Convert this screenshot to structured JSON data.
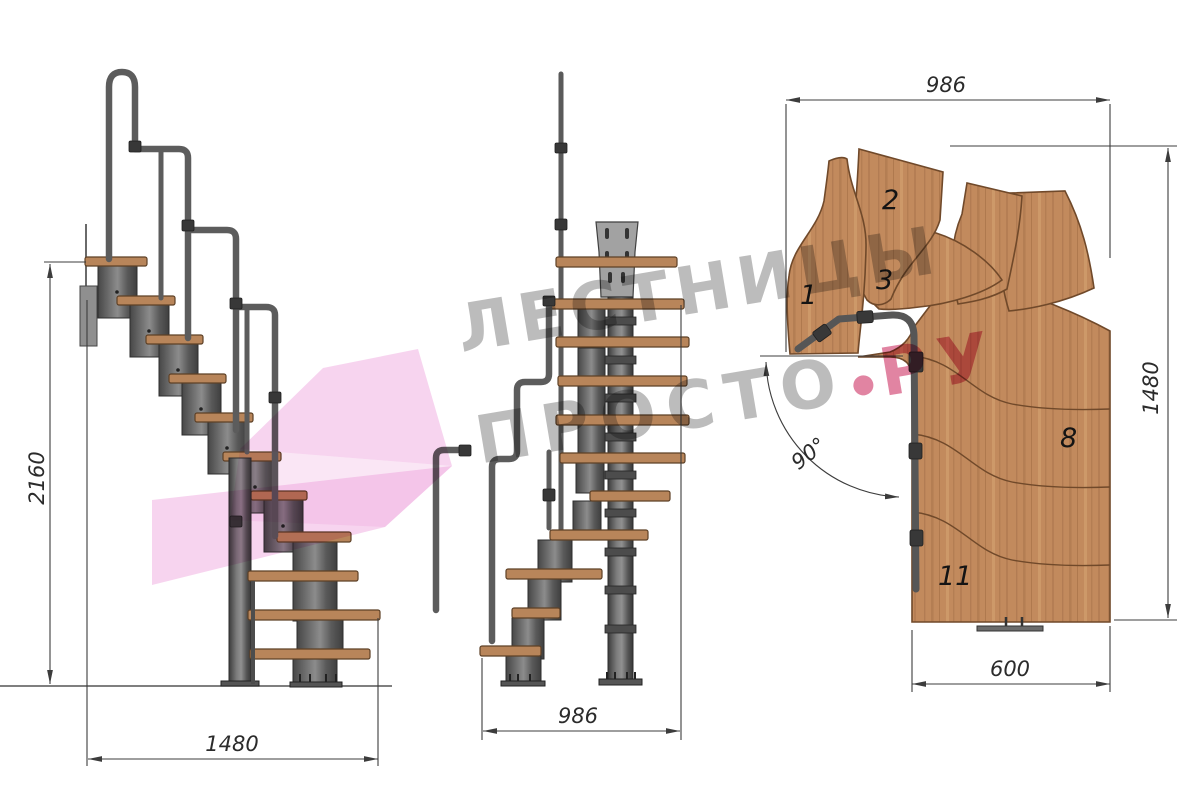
{
  "watermark": {
    "line1": "ЛЕСТНИЦЫ",
    "line2_left": "ПРОСТО",
    "line2_right": "РУ"
  },
  "side_view": {
    "dim_height": "2160",
    "dim_depth": "1480"
  },
  "front_view": {
    "dim_width": "986"
  },
  "plan_view": {
    "dim_width_top": "986",
    "dim_height": "1480",
    "dim_bottom_width": "600",
    "turn_angle": "90°",
    "tread_numbers": {
      "n1": "1",
      "n2": "2",
      "n3": "3",
      "n8": "8",
      "n11": "11"
    }
  },
  "colors": {
    "wood": "#c28a5d",
    "wood_outline": "#70492a",
    "metal_module": "#5a5a5a",
    "handrail_tube": "#5c5c5c",
    "dimension_line": "#3c3c3c",
    "watermark_gray": "#9b9b9b",
    "watermark_pink": "#c91f56",
    "logo_pink": "#f0a9de"
  }
}
